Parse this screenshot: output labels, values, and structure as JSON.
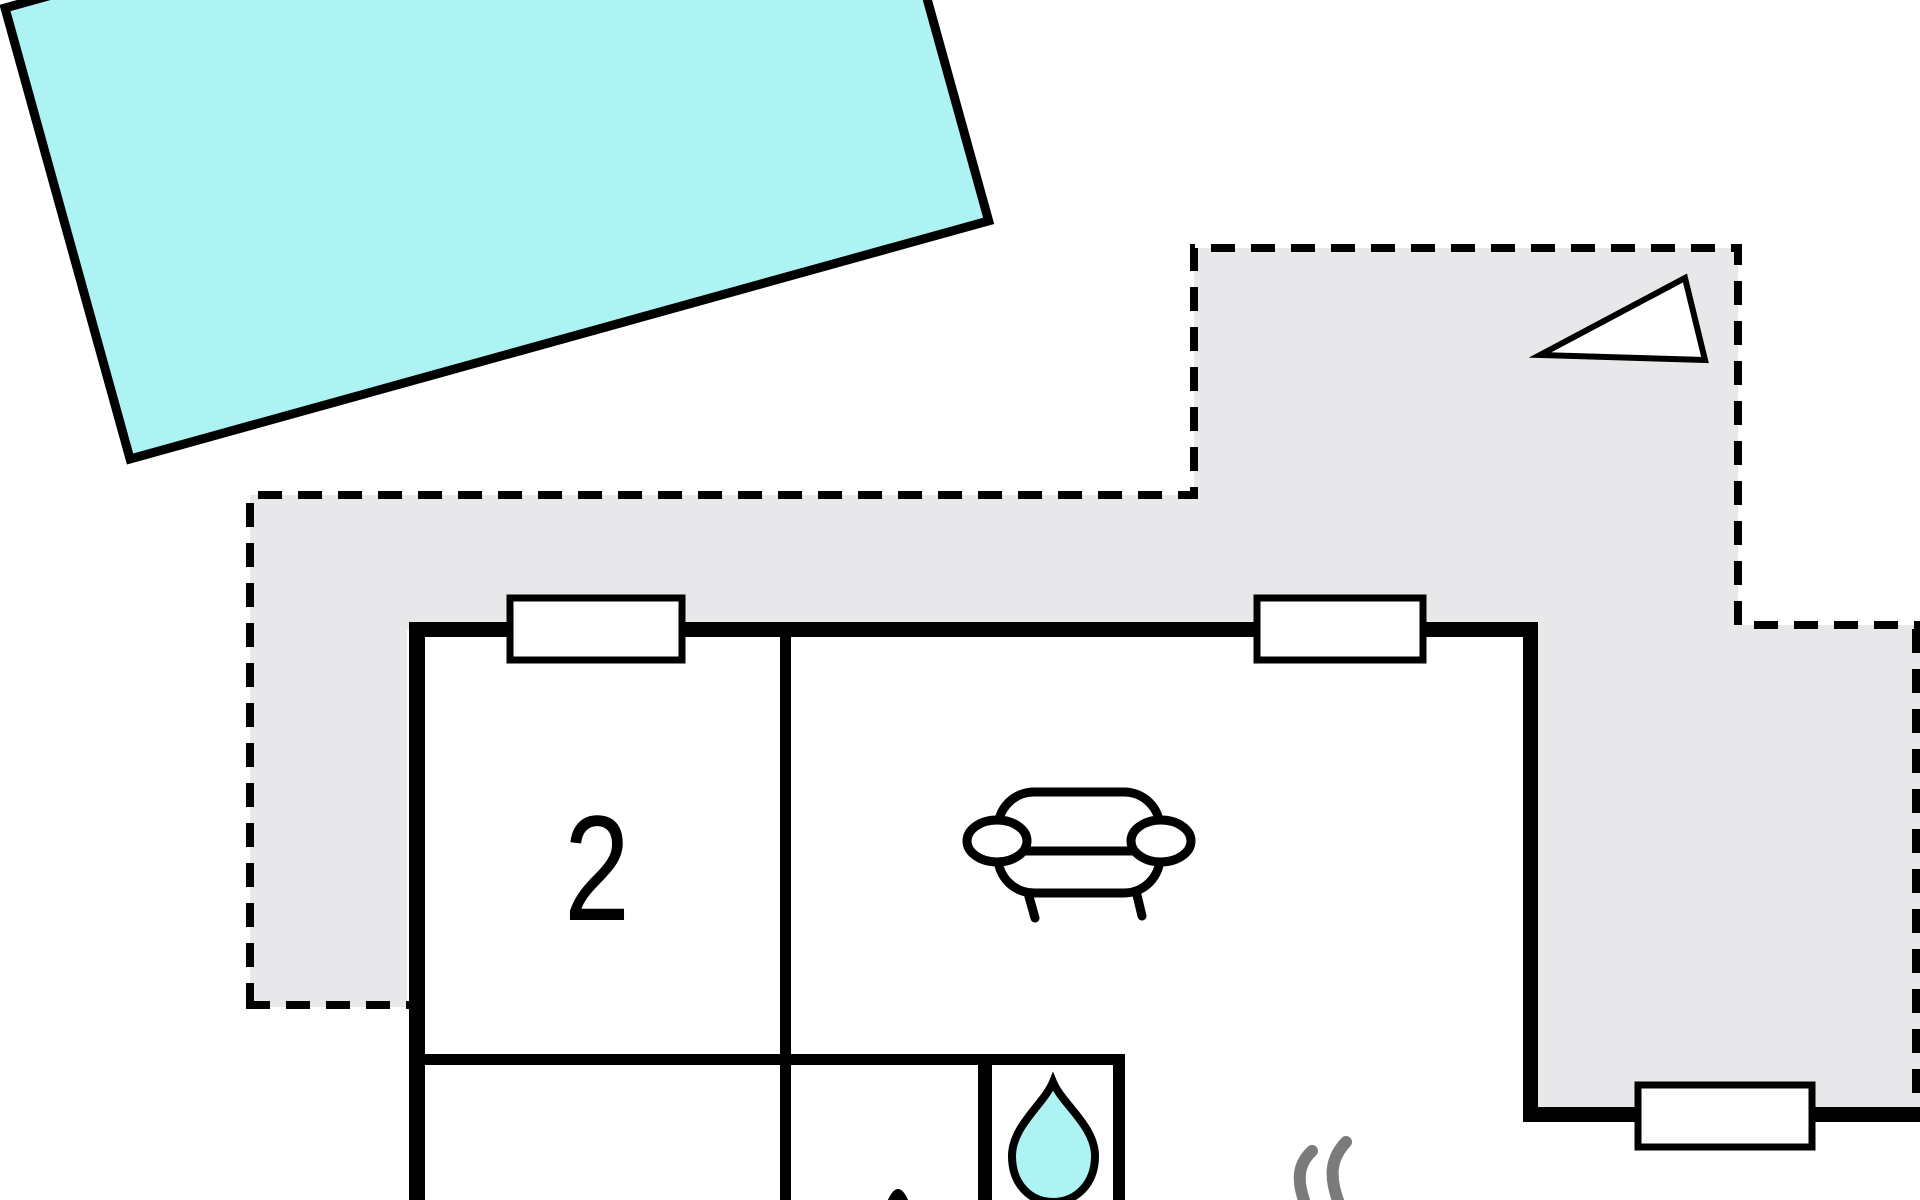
{
  "plan": {
    "type": "floor-plan",
    "room_label": "2"
  },
  "colors": {
    "water": "#aef3f4",
    "terrace": "#e8e7ea",
    "wall": "#000000",
    "window_fill": "#ffffff",
    "heat_marks": "#7b7b7b"
  },
  "icons": {
    "pool": "pool",
    "terrace": "terrace-dashed-area",
    "sofa": "sofa-icon",
    "water_drop": "water-drop-icon",
    "heat_marks": "heat-marks-icon",
    "triangle": "opening-triangle-icon",
    "window": "window-symbol"
  }
}
